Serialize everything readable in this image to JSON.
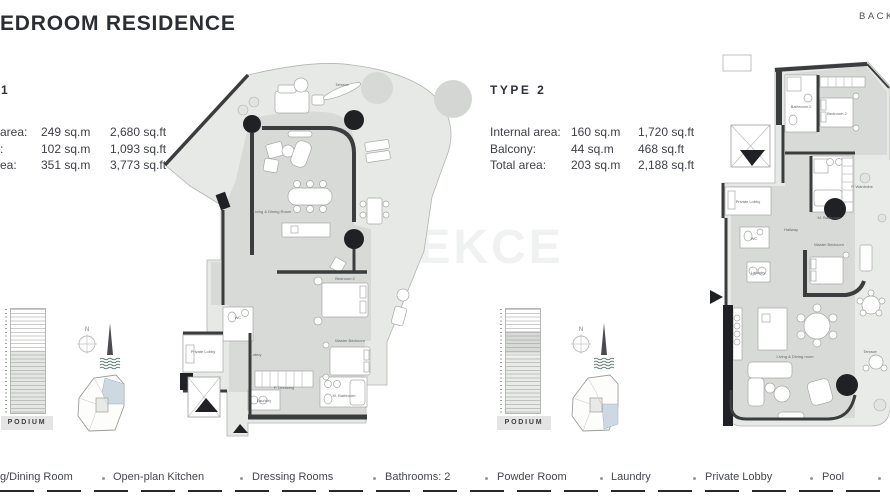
{
  "header": {
    "title": "EDROOM RESIDENCE",
    "back": "BACK"
  },
  "watermark": "TEKCE",
  "type1": {
    "heading": "1",
    "stats": [
      {
        "label": "area:",
        "sqm": "249 sq.m",
        "sqft": "2,680 sq.ft"
      },
      {
        "label": ":",
        "sqm": "102 sq.m",
        "sqft": "1,093 sq.ft"
      },
      {
        "label": "ea:",
        "sqm": "351 sq.m",
        "sqft": "3,773 sq.ft"
      }
    ],
    "podium": "PODIUM",
    "compass_n": "N",
    "rooms": {
      "terrace": "Terrace",
      "living": "Living & Dining Room",
      "bedroom2": "Bedroom 2",
      "master": "Master Bedroom",
      "lobby": "Lobby",
      "private_lobby": "Private Lobby",
      "wc": "WC",
      "laundry": "Laundry",
      "dressing": "P. Dressing",
      "bathroom": "M. Bathroom"
    }
  },
  "type2": {
    "heading": "TYPE 2",
    "stats": [
      {
        "label": "Internal area:",
        "sqm": "160 sq.m",
        "sqft": "1,720 sq.ft"
      },
      {
        "label": "Balcony:",
        "sqm": "44 sq.m",
        "sqft": "468 sq.ft"
      },
      {
        "label": "Total area:",
        "sqm": "203 sq.m",
        "sqft": "2,188 sq.ft"
      }
    ],
    "podium": "PODIUM",
    "compass_n": "N",
    "rooms": {
      "bathroom2": "Bathroom 2",
      "bedroom2": "Bedroom 2",
      "hallway": "Hallway",
      "m_bathroom": "M. Bathroom",
      "wardrobe": "P. Wardrobe",
      "private_lobby": "Private Lobby",
      "wc": "WC",
      "laundry": "Laundry",
      "master": "Master Bedroom",
      "living": "Living & Dining room",
      "terrace": "Terrace"
    }
  },
  "legend": {
    "items": [
      "g/Dining Room",
      "Open-plan Kitchen",
      "Dressing Rooms",
      "Bathrooms: 2",
      "Powder Room",
      "Laundry",
      "Private Lobby",
      "Pool"
    ]
  },
  "colors": {
    "wall": "#3b3c3e",
    "plan_interior": "#d8dad7",
    "plan_balcony": "#e7e9e6",
    "keyplan_highlight": "#cdd8e1",
    "water_waves": "#4e6f65",
    "heading_text": "#2b2e35"
  }
}
